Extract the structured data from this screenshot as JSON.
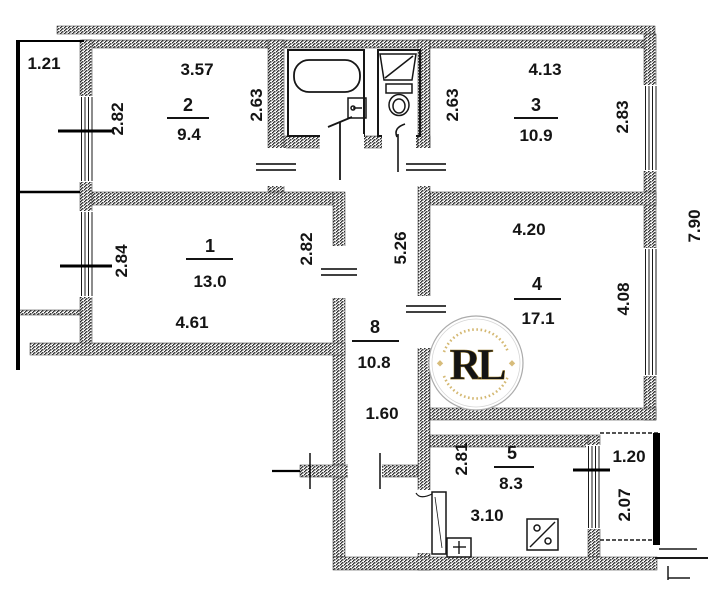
{
  "plan": {
    "balcony_top_left": {
      "width": "1.21"
    },
    "balcony_bottom_right": {
      "width": "1.20",
      "depth": "2.07"
    },
    "building": {
      "right_dim": "7.90"
    },
    "room2": {
      "number": "2",
      "area": "9.4",
      "top": "3.57",
      "left": "2.82",
      "right": "2.63"
    },
    "room3": {
      "number": "3",
      "area": "10.9",
      "top": "4.13",
      "left": "2.63",
      "right": "2.83"
    },
    "room1": {
      "number": "1",
      "area": "13.0",
      "left": "2.84",
      "right": "2.82",
      "bottom": "4.61"
    },
    "room4": {
      "number": "4",
      "area": "17.1",
      "top": "4.20",
      "right": "4.08"
    },
    "hall8": {
      "number": "8",
      "area": "10.8",
      "right": "5.26",
      "bottom": "1.60"
    },
    "kitchen5": {
      "number": "5",
      "area": "8.3",
      "left": "2.81",
      "bottom": "3.10"
    }
  },
  "watermark": {
    "initials": "RL",
    "gold": "#b98a2e",
    "ring": "#ababab"
  }
}
